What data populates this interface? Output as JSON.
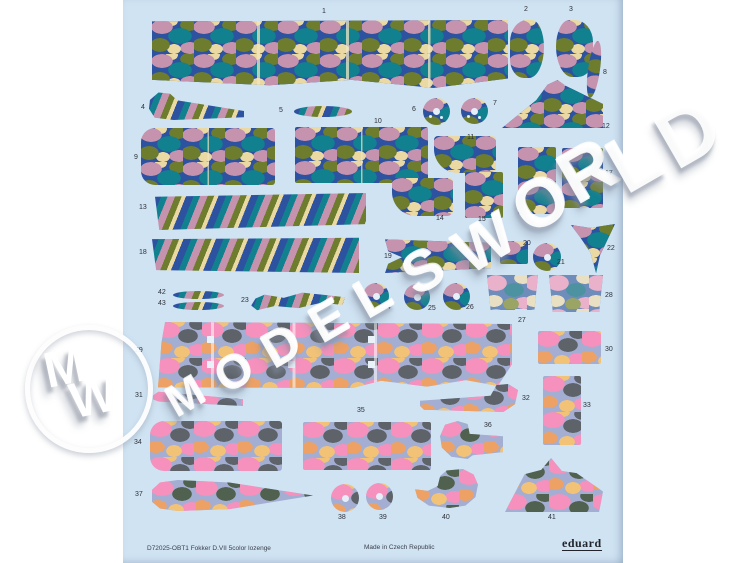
{
  "product": {
    "catalog_text": "D72025-OBT1 Fokker D.VII 5color lozenge",
    "origin_text": "Made in Czech Republic",
    "brand": "eduard"
  },
  "watermark": {
    "text": "MODELSWORLD",
    "monogram_m": "M",
    "monogram_w": "W"
  },
  "colors": {
    "page_background": "#ffffff",
    "sheet_background": "#cfe3f3",
    "upper_lozenge": [
      "#2d52a0",
      "#11808f",
      "#6d7d2d",
      "#c693af",
      "#ead9a3"
    ],
    "lower_lozenge": [
      "#a3aed2",
      "#f591bc",
      "#eda164",
      "#f2c377",
      "#5d6369"
    ],
    "lower_dark_lozenge": [
      "#a3aed2",
      "#f591bc",
      "#eda164",
      "#f2c377",
      "#51614f"
    ],
    "faded_lozenge": [
      "#6f8dbb",
      "#eab1cb",
      "#e9e0c3",
      "#4c92a1",
      "#9aa464"
    ],
    "label_text": "#2e3038"
  },
  "pieces": [
    {
      "n": "1",
      "pat": "u",
      "shape": "band1",
      "x": 152,
      "y": 20,
      "w": 356,
      "h": 68,
      "lx": 322,
      "ly": 8,
      "lines": "l3"
    },
    {
      "n": "2",
      "pat": "u",
      "shape": "blobL",
      "x": 510,
      "y": 20,
      "w": 34,
      "h": 58,
      "lx": 524,
      "ly": 6
    },
    {
      "n": "3",
      "pat": "u",
      "shape": "blobR",
      "x": 556,
      "y": 20,
      "w": 37,
      "h": 57,
      "lx": 569,
      "ly": 6
    },
    {
      "n": "4",
      "pat": "ud",
      "shape": "stick",
      "x": 149,
      "y": 92,
      "w": 95,
      "h": 28,
      "lx": 141,
      "ly": 104
    },
    {
      "n": "5",
      "pat": "ud",
      "shape": "lens",
      "x": 294,
      "y": 106,
      "w": 58,
      "h": 11,
      "lx": 279,
      "ly": 107
    },
    {
      "n": "6",
      "pat": "u",
      "shape": "disc3",
      "x": 423,
      "y": 98,
      "w": 27,
      "h": 27,
      "lx": 412,
      "ly": 106
    },
    {
      "n": "7",
      "pat": "u",
      "shape": "disc3",
      "x": 461,
      "y": 98,
      "w": 27,
      "h": 26,
      "lx": 493,
      "ly": 100
    },
    {
      "n": "8",
      "pat": "u",
      "shape": "crescent",
      "x": 588,
      "y": 41,
      "w": 12,
      "h": 57,
      "lx": 603,
      "ly": 69,
      "rot": 8
    },
    {
      "n": "9",
      "pat": "u",
      "shape": "rrectL",
      "x": 141,
      "y": 128,
      "w": 134,
      "h": 57,
      "lx": 134,
      "ly": 154,
      "lines": "l1"
    },
    {
      "n": "10",
      "pat": "u",
      "shape": "rect",
      "x": 295,
      "y": 127,
      "w": 133,
      "h": 56,
      "lx": 374,
      "ly": 118,
      "lines": "l1"
    },
    {
      "n": "11",
      "pat": "u",
      "shape": "rbl",
      "x": 434,
      "y": 136,
      "w": 62,
      "h": 37,
      "lx": 467,
      "ly": 134
    },
    {
      "n": "12",
      "pat": "u",
      "shape": "fin",
      "x": 502,
      "y": 80,
      "w": 101,
      "h": 48,
      "lx": 602,
      "ly": 123
    },
    {
      "n": "13",
      "pat": "ud",
      "shape": "bandA",
      "x": 155,
      "y": 193,
      "w": 211,
      "h": 37,
      "lx": 139,
      "ly": 204
    },
    {
      "n": "14",
      "pat": "u",
      "shape": "rbl",
      "x": 392,
      "y": 178,
      "w": 61,
      "h": 38,
      "lx": 436,
      "ly": 215
    },
    {
      "n": "15",
      "pat": "u",
      "shape": "rect",
      "x": 465,
      "y": 172,
      "w": 38,
      "h": 46,
      "lx": 478,
      "ly": 216
    },
    {
      "n": "16",
      "pat": "u",
      "shape": "rect",
      "x": 518,
      "y": 147,
      "w": 38,
      "h": 67,
      "lx": 529,
      "ly": 218
    },
    {
      "n": "17",
      "pat": "u",
      "shape": "rect",
      "x": 562,
      "y": 148,
      "w": 41,
      "h": 60,
      "lx": 605,
      "ly": 170
    },
    {
      "n": "18",
      "pat": "ud",
      "shape": "bandB",
      "x": 152,
      "y": 237,
      "w": 207,
      "h": 36,
      "lx": 139,
      "ly": 249
    },
    {
      "n": "19",
      "pat": "u",
      "shape": "bracket",
      "x": 385,
      "y": 238,
      "w": 106,
      "h": 35,
      "lx": 384,
      "ly": 253
    },
    {
      "n": "20",
      "pat": "u",
      "shape": "rect",
      "x": 500,
      "y": 241,
      "w": 28,
      "h": 23,
      "lx": 523,
      "ly": 240
    },
    {
      "n": "21",
      "pat": "u",
      "shape": "disc",
      "x": 533,
      "y": 243,
      "w": 28,
      "h": 28,
      "lx": 557,
      "ly": 259
    },
    {
      "n": "22",
      "pat": "u",
      "shape": "wedge",
      "x": 571,
      "y": 224,
      "w": 44,
      "h": 49,
      "lx": 607,
      "ly": 245
    },
    {
      "n": "23",
      "pat": "ud",
      "shape": "serp",
      "x": 251,
      "y": 292,
      "w": 94,
      "h": 17,
      "lx": 241,
      "ly": 297,
      "rot": -3
    },
    {
      "n": "24",
      "pat": "u",
      "shape": "disc",
      "x": 363,
      "y": 283,
      "w": 26,
      "h": 26,
      "lx": 383,
      "ly": 304
    },
    {
      "n": "25",
      "pat": "u",
      "shape": "disc",
      "x": 404,
      "y": 284,
      "w": 26,
      "h": 26,
      "lx": 428,
      "ly": 305
    },
    {
      "n": "26",
      "pat": "u",
      "shape": "disc",
      "x": 443,
      "y": 283,
      "w": 27,
      "h": 27,
      "lx": 466,
      "ly": 304
    },
    {
      "n": "27",
      "pat": "f",
      "shape": "trap",
      "x": 487,
      "y": 275,
      "w": 51,
      "h": 35,
      "lx": 518,
      "ly": 317
    },
    {
      "n": "28",
      "pat": "f",
      "shape": "trap",
      "x": 549,
      "y": 275,
      "w": 54,
      "h": 37,
      "lx": 605,
      "ly": 292
    },
    {
      "n": "29",
      "pat": "l",
      "shape": "band29",
      "x": 158,
      "y": 322,
      "w": 354,
      "h": 66,
      "lx": 135,
      "ly": 347,
      "lines": "l29"
    },
    {
      "n": "30",
      "pat": "l",
      "shape": "rect",
      "x": 538,
      "y": 331,
      "w": 63,
      "h": 33,
      "lx": 605,
      "ly": 346
    },
    {
      "n": "31",
      "pat": "l",
      "shape": "strip31",
      "x": 153,
      "y": 391,
      "w": 90,
      "h": 15,
      "lx": 135,
      "ly": 392
    },
    {
      "n": "32",
      "pat": "l",
      "shape": "hook32",
      "x": 420,
      "y": 384,
      "w": 98,
      "h": 28,
      "lx": 522,
      "ly": 395
    },
    {
      "n": "33",
      "pat": "l",
      "shape": "rect",
      "x": 543,
      "y": 376,
      "w": 38,
      "h": 69,
      "lx": 583,
      "ly": 402
    },
    {
      "n": "34",
      "pat": "l",
      "shape": "rrectL",
      "x": 150,
      "y": 421,
      "w": 132,
      "h": 50,
      "lx": 134,
      "ly": 439
    },
    {
      "n": "35",
      "pat": "l",
      "shape": "rect",
      "x": 303,
      "y": 422,
      "w": 128,
      "h": 48,
      "lx": 357,
      "ly": 407
    },
    {
      "n": "36",
      "pat": "ld",
      "shape": "boot36",
      "x": 440,
      "y": 421,
      "w": 63,
      "h": 38,
      "lx": 484,
      "ly": 422
    },
    {
      "n": "37",
      "pat": "ld",
      "shape": "blade37",
      "x": 152,
      "y": 480,
      "w": 161,
      "h": 31,
      "lx": 135,
      "ly": 491
    },
    {
      "n": "38",
      "pat": "l",
      "shape": "disc",
      "x": 331,
      "y": 484,
      "w": 28,
      "h": 28,
      "lx": 338,
      "ly": 514
    },
    {
      "n": "39",
      "pat": "l",
      "shape": "disc",
      "x": 366,
      "y": 483,
      "w": 27,
      "h": 27,
      "lx": 379,
      "ly": 514
    },
    {
      "n": "40",
      "pat": "ld",
      "shape": "boot40",
      "x": 415,
      "y": 469,
      "w": 63,
      "h": 39,
      "lx": 442,
      "ly": 514
    },
    {
      "n": "41",
      "pat": "ld",
      "shape": "tent41",
      "x": 505,
      "y": 458,
      "w": 98,
      "h": 54,
      "lx": 548,
      "ly": 514
    },
    {
      "n": "42",
      "pat": "ud",
      "shape": "lens",
      "x": 173,
      "y": 291,
      "w": 51,
      "h": 8,
      "lx": 158,
      "ly": 289
    },
    {
      "n": "43",
      "pat": "ud",
      "shape": "lens",
      "x": 173,
      "y": 302,
      "w": 51,
      "h": 8,
      "lx": 158,
      "ly": 300
    }
  ]
}
